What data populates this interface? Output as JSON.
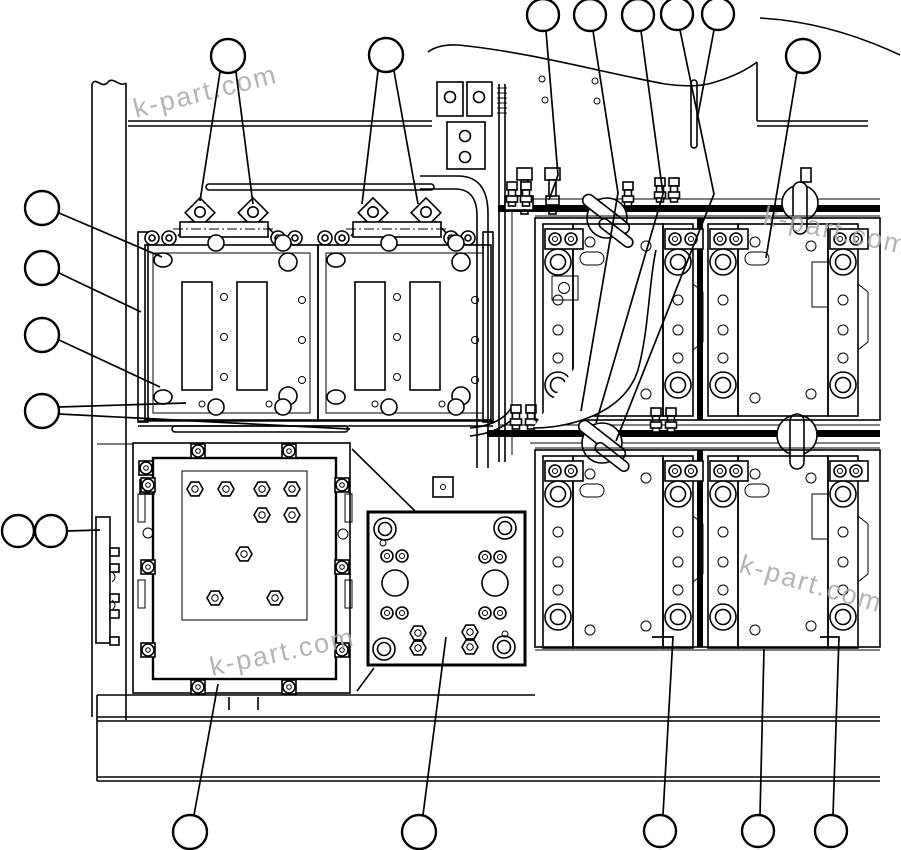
{
  "diagram": {
    "type": "parts-exploded-diagram",
    "background_color": "#ffffff",
    "line_color": "#000000",
    "watermark": {
      "text": "k-part.com",
      "color": "#a8a8a8",
      "font_size": 27,
      "instances": [
        {
          "x": 136,
          "y": 118,
          "rotation": -14
        },
        {
          "x": 762,
          "y": 224,
          "rotation": 12
        },
        {
          "x": 738,
          "y": 572,
          "rotation": 16
        },
        {
          "x": 212,
          "y": 676,
          "rotation": -12
        }
      ]
    },
    "callouts": [
      {
        "id": "c1",
        "cx": 228,
        "cy": 56,
        "r": 17,
        "leaders": [
          [
            [
              220,
              72
            ],
            [
              200,
              201
            ]
          ],
          [
            [
              236,
              72
            ],
            [
              253,
              204
            ]
          ]
        ]
      },
      {
        "id": "c2",
        "cx": 386,
        "cy": 55,
        "r": 17,
        "leaders": [
          [
            [
              378,
              71
            ],
            [
              362,
              204
            ]
          ],
          [
            [
              394,
              71
            ],
            [
              418,
              204
            ]
          ]
        ]
      },
      {
        "id": "c3",
        "cx": 543,
        "cy": 15,
        "r": 16,
        "leaders": [
          [
            [
              546,
              31
            ],
            [
              558,
              175
            ],
            [
              549,
              200
            ]
          ]
        ]
      },
      {
        "id": "c4",
        "cx": 590,
        "cy": 15,
        "r": 16,
        "leaders": [
          [
            [
              593,
              31
            ],
            [
              618,
              193
            ],
            [
              581,
              411
            ]
          ]
        ]
      },
      {
        "id": "c5",
        "cx": 638,
        "cy": 15,
        "r": 16,
        "leaders": [
          [
            [
              641,
              31
            ],
            [
              663,
              194
            ],
            [
              596,
              423
            ]
          ]
        ]
      },
      {
        "id": "c6",
        "cx": 677,
        "cy": 14,
        "r": 16,
        "leaders": [
          [
            [
              680,
              30
            ],
            [
              714,
              194
            ],
            [
              616,
              441
            ]
          ]
        ]
      },
      {
        "id": "c7",
        "cx": 718,
        "cy": 14,
        "r": 16,
        "leaders": [
          [
            [
              714,
              30
            ],
            [
              697,
              120
            ]
          ]
        ]
      },
      {
        "id": "c8",
        "cx": 803,
        "cy": 56,
        "r": 17,
        "leaders": [
          [
            [
              797,
              72
            ],
            [
              766,
              258
            ]
          ]
        ]
      },
      {
        "id": "c9",
        "cx": 42,
        "cy": 208,
        "r": 17,
        "leaders": [
          [
            [
              59,
              213
            ],
            [
              162,
              257
            ]
          ]
        ]
      },
      {
        "id": "c10",
        "cx": 42,
        "cy": 268,
        "r": 17,
        "leaders": [
          [
            [
              59,
              273
            ],
            [
              141,
              312
            ]
          ]
        ]
      },
      {
        "id": "c11",
        "cx": 42,
        "cy": 335,
        "r": 17,
        "leaders": [
          [
            [
              59,
              340
            ],
            [
              160,
              387
            ]
          ]
        ]
      },
      {
        "id": "c12",
        "cx": 42,
        "cy": 411,
        "r": 17,
        "leaders": [
          [
            [
              59,
              407
            ],
            [
              186,
              403
            ]
          ],
          [
            [
              59,
              414
            ],
            [
              350,
              429
            ]
          ]
        ]
      },
      {
        "id": "c13",
        "cx": 18,
        "cy": 531,
        "r": 16,
        "leaders": []
      },
      {
        "id": "c14",
        "cx": 51,
        "cy": 531,
        "r": 16,
        "leaders": [
          [
            [
              67,
              531
            ],
            [
              100,
              530
            ]
          ]
        ]
      },
      {
        "id": "c15",
        "cx": 190,
        "cy": 832,
        "r": 17,
        "leaders": [
          [
            [
              194,
              815
            ],
            [
              218,
              684
            ]
          ]
        ]
      },
      {
        "id": "c16",
        "cx": 419,
        "cy": 832,
        "r": 17,
        "leaders": [
          [
            [
              423,
              815
            ],
            [
              446,
              637
            ]
          ]
        ]
      },
      {
        "id": "c17",
        "cx": 660,
        "cy": 831,
        "r": 16,
        "leaders": [
          [
            [
              663,
              815
            ],
            [
              673,
              637
            ],
            [
              652,
              637
            ]
          ]
        ]
      },
      {
        "id": "c18",
        "cx": 758,
        "cy": 831,
        "r": 16,
        "leaders": [
          [
            [
              760,
              815
            ],
            [
              764,
              649
            ]
          ]
        ]
      },
      {
        "id": "c19",
        "cx": 831,
        "cy": 831,
        "r": 16,
        "leaders": [
          [
            [
              833,
              815
            ],
            [
              839,
              637
            ],
            [
              820,
              637
            ]
          ]
        ]
      }
    ]
  }
}
